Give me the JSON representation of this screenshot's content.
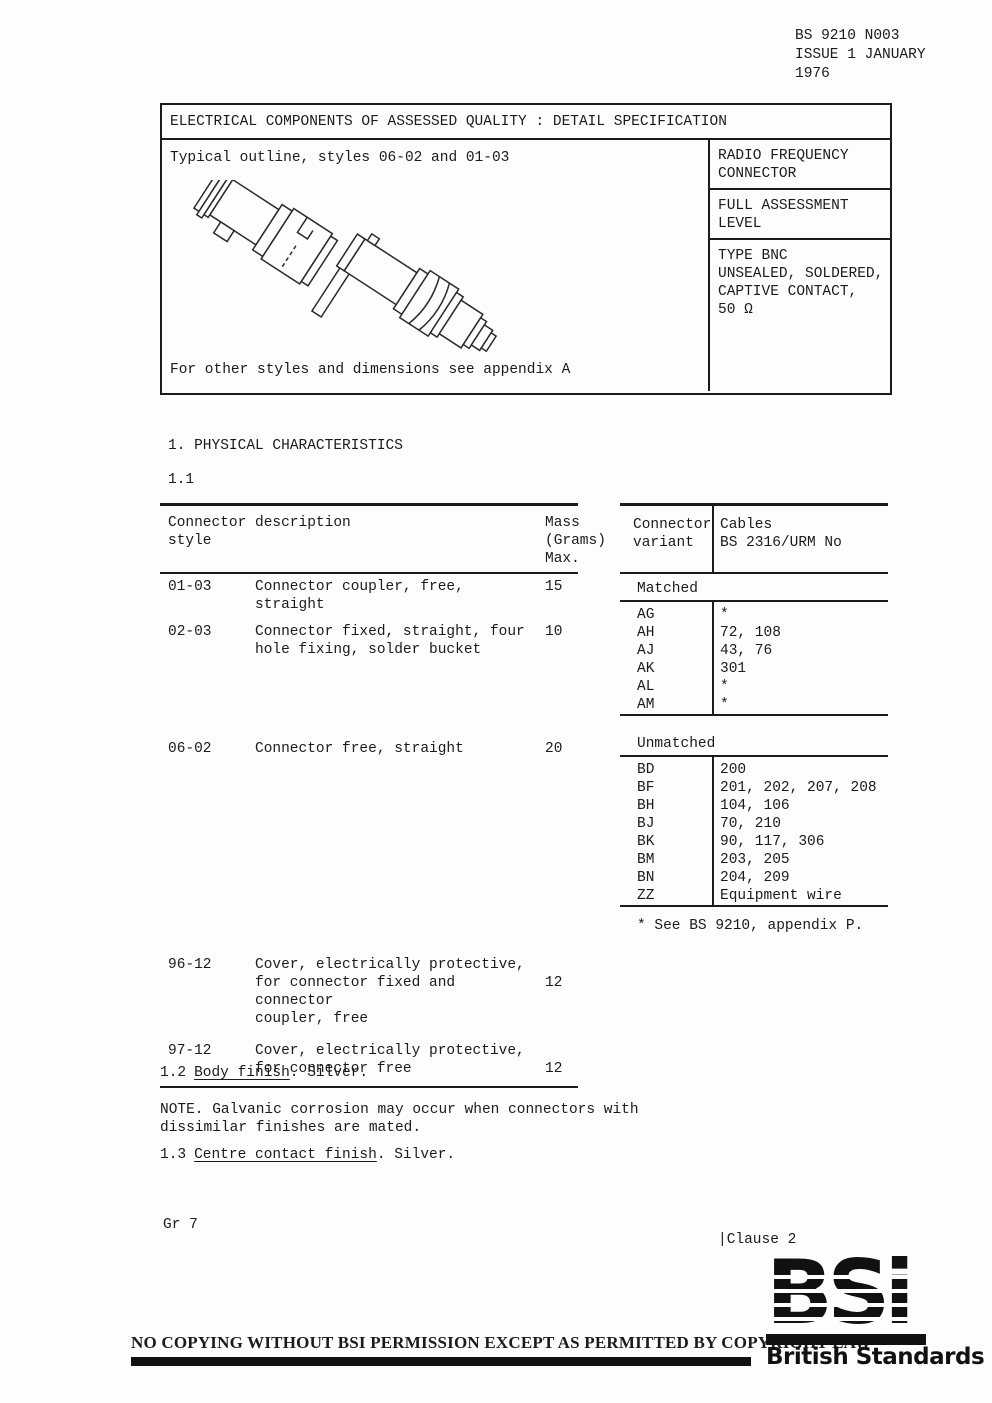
{
  "doc_ref": {
    "lines": [
      "BS 9210 N003",
      "ISSUE 1 JANUARY",
      "1976"
    ]
  },
  "spec_table": {
    "title": "ELECTRICAL COMPONENTS OF ASSESSED QUALITY : DETAIL SPECIFICATION",
    "outline_caption": "Typical outline, styles 06-02 and 01-03",
    "outline_note": "For other styles and dimensions see appendix A",
    "side_cells": [
      {
        "lines": [
          "RADIO FREQUENCY",
          "CONNECTOR"
        ]
      },
      {
        "lines": [
          "FULL ASSESSMENT",
          "LEVEL"
        ]
      },
      {
        "lines": [
          "TYPE BNC",
          "UNSEALED, SOLDERED,",
          "CAPTIVE CONTACT,",
          "50 Ω"
        ]
      }
    ]
  },
  "section": {
    "heading": "1. PHYSICAL CHARACTERISTICS",
    "subsection": "1.1"
  },
  "mass_table": {
    "header": {
      "col1_lines": [
        "Connector",
        "style"
      ],
      "col2": "description",
      "col3_lines": [
        "Mass",
        "(Grams)",
        "Max."
      ]
    },
    "rows": [
      {
        "style": "01-03",
        "desc": [
          "Connector coupler, free, straight"
        ],
        "mass": "15"
      },
      {
        "style": "02-03",
        "desc": [
          "Connector fixed, straight, four",
          "hole fixing, solder bucket"
        ],
        "mass": "10"
      },
      {
        "style": "06-02",
        "desc": [
          "Connector free, straight"
        ],
        "mass": "20"
      },
      {
        "style": "96-12",
        "desc": [
          "Cover, electrically protective,",
          "for connector fixed and connector",
          "coupler, free"
        ],
        "mass": "12"
      },
      {
        "style": "97-12",
        "desc": [
          "Cover, electrically protective,",
          "for connector free"
        ],
        "mass": "12"
      }
    ]
  },
  "cable_table": {
    "header": {
      "col1_lines": [
        "Connector",
        "variant"
      ],
      "col2_lines": [
        "Cables",
        "BS 2316/URM No"
      ]
    },
    "matched_label": "Matched",
    "matched_rows": [
      [
        "AG",
        "*"
      ],
      [
        "AH",
        "72, 108"
      ],
      [
        "AJ",
        "43, 76"
      ],
      [
        "AK",
        "301"
      ],
      [
        "AL",
        "*"
      ],
      [
        "AM",
        "*"
      ]
    ],
    "unmatched_label": "Unmatched",
    "unmatched_rows": [
      [
        "BD",
        "200"
      ],
      [
        "BF",
        "201, 202, 207, 208"
      ],
      [
        "BH",
        "104, 106"
      ],
      [
        "BJ",
        "70, 210"
      ],
      [
        "BK",
        "90, 117, 306"
      ],
      [
        "BM",
        "203, 205"
      ],
      [
        "BN",
        "204, 209"
      ],
      [
        "ZZ",
        "Equipment wire"
      ]
    ],
    "footnote": "* See BS 9210, appendix P."
  },
  "clause_1_2": {
    "number": "1.2",
    "label": "Body finish",
    "rest": ". Silver."
  },
  "note": {
    "lines": [
      "NOTE. Galvanic corrosion may occur when connectors with",
      "dissimilar finishes are mated."
    ]
  },
  "clause_1_3": {
    "number": "1.3",
    "label": "Centre contact finish",
    "rest": ". Silver."
  },
  "footer": {
    "price_group": "Gr 7",
    "clause_ref": "|Clause 2",
    "copyright_notice": "NO COPYING WITHOUT BSI PERMISSION EXCEPT AS PERMITTED BY COPYRIGHT LAW",
    "bsi_logo_text": "BSi",
    "bsi_logo_caption": "British Standards"
  },
  "colors": {
    "ink": "#1b1b1b",
    "paper": "#fdfdfb"
  }
}
